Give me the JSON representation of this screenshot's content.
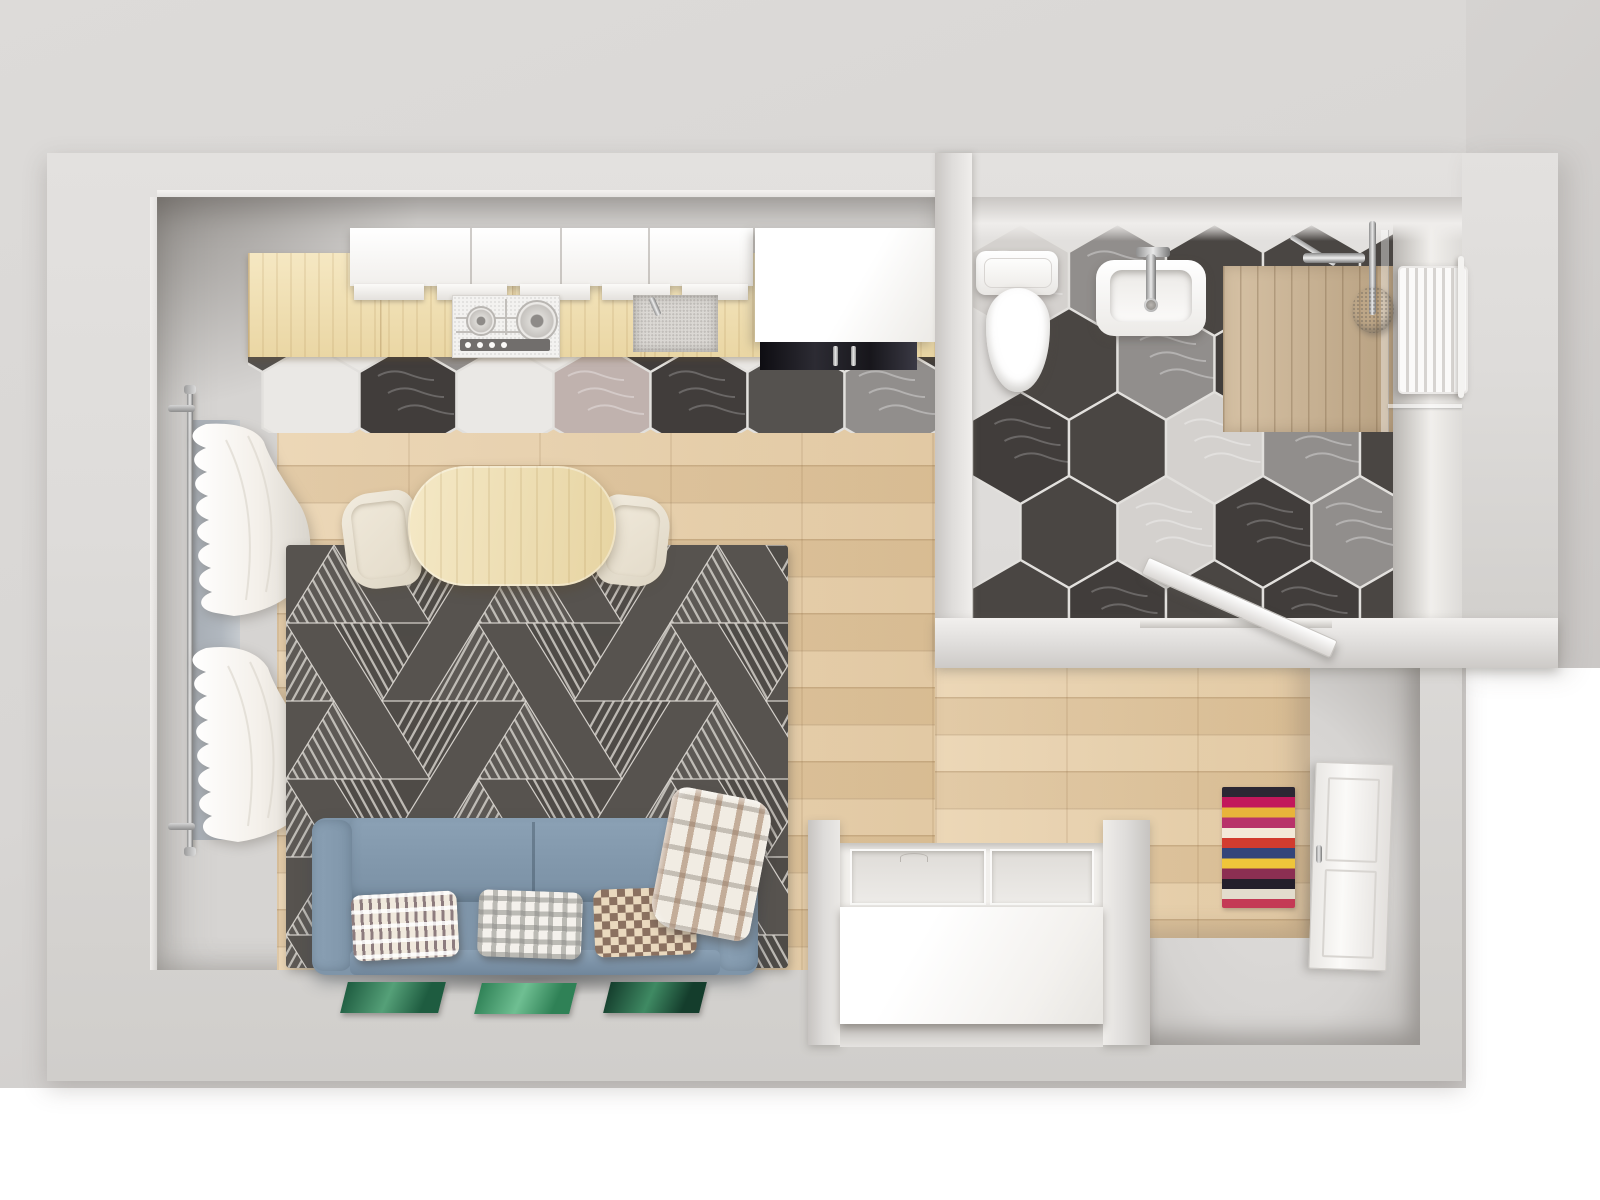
{
  "scene": {
    "kind": "apartment-floor-plan-3d-top-view",
    "rooms": [
      {
        "id": "living-kitchen",
        "floor": "wood-planks"
      },
      {
        "id": "bathroom",
        "floor": "hexagon-tiles"
      },
      {
        "id": "hallway",
        "floor": "wood-planks"
      }
    ],
    "objects": [
      "kitchen-counter",
      "gas-hob",
      "kitchen-sink",
      "upper-cabinets",
      "tall-cabinet",
      "black-appliance",
      "dining-table",
      "chair-left",
      "chair-right",
      "area-rug",
      "sofa",
      "pillow-triangles",
      "pillow-gingham",
      "pillow-checker",
      "plaid-blanket",
      "green-canvases",
      "window-curtains",
      "curtain-rod",
      "toilet",
      "bathroom-sink",
      "shower-deck",
      "shower-column",
      "towel-radiator",
      "pebble-mat",
      "bathroom-door",
      "entry-door",
      "hall-runner-rug",
      "wardrobe-unit"
    ]
  },
  "palette": {
    "backdrop": "#d8d6d4",
    "backdrop_dark": "#cbc8c6",
    "wall": "#dedcda",
    "wall_face": "#f1efed",
    "floor": "#d6d4d2",
    "wood": "#e6cba1",
    "counter": "#f2e0ae",
    "shower_wood": "#cfb795",
    "tile_white": "#eae8e5",
    "tile_light": "#d4d1ce",
    "tile_gray": "#918e8c",
    "tile_pink": "#c0b2ae",
    "tile_dark": "#55524f",
    "tile_darkvein": "#413d3b",
    "tile_bath_dark": "#4a4643",
    "grout": "#e2e0dd",
    "rug_bg": "#57534f",
    "rug_tri_a": "#5e5a56",
    "rug_tri_b": "#4f4b47",
    "rug_line": "#d9d5cf",
    "sofa": "#7f95a9",
    "sofa_dark": "#70869b",
    "sofa_light": "#8ba1b5",
    "cream": "#ece5d6",
    "chrome_l": "#e9e9e9",
    "chrome_d": "#8f8f8f",
    "glass": "#aab2bb",
    "curtain": "#f4f0ea",
    "appliance": "#1a191d",
    "knob_strip": "#716e6c",
    "pillow_base": "#f0e9dd",
    "pillow_brown": "#8b7160",
    "green_a": "#1e5c40",
    "green_b": "#2f8156",
    "green_c": "#143d2c"
  },
  "kitchen_backsplash": {
    "s": 56,
    "pitch": 97,
    "dark_key": "tile_dark",
    "rows": [
      {
        "cy": 43,
        "x0": 63,
        "colors": [
          "white",
          "darkvein",
          "white",
          "pink",
          "darkvein",
          "dark",
          "gray"
        ]
      },
      {
        "cy": -41,
        "x0": 14.5,
        "colors": [
          "dark",
          "white",
          "gray",
          "white",
          "darkvein",
          "white",
          "dark",
          "darkvein"
        ]
      }
    ]
  },
  "bathroom_floor": {
    "s": 56,
    "pitch": 97,
    "dark_key": "tile_bath_dark",
    "rows": [
      {
        "cy": 70,
        "x0": 48.5,
        "colors": [
          "light",
          "gray",
          "dark",
          "dark",
          "dark"
        ]
      },
      {
        "cy": 154,
        "x0": 97,
        "colors": [
          "dark",
          "gray",
          "darkvein",
          "dark",
          "dark"
        ]
      },
      {
        "cy": 238,
        "x0": 48.5,
        "colors": [
          "darkvein",
          "dark",
          "light",
          "gray",
          "dark"
        ]
      },
      {
        "cy": 322,
        "x0": 97,
        "colors": [
          "dark",
          "light",
          "darkvein",
          "gray",
          "pink"
        ]
      },
      {
        "cy": 406,
        "x0": 48.5,
        "colors": [
          "dark",
          "darkvein",
          "dark",
          "darkvein",
          "dark"
        ]
      }
    ]
  },
  "living_rug": {
    "width": 502,
    "height": 423,
    "tri_half": 48,
    "tri_h": 78,
    "rows": 6,
    "cols": 12
  },
  "hall_rug": {
    "stripes": [
      "#2b2733",
      "#c2185b",
      "#e8b43a",
      "#b8336a",
      "#f3ead9",
      "#d23c2f",
      "#34457a",
      "#efc53a",
      "#8c2f52",
      "#241f2b",
      "#e3dccd",
      "#c43a55"
    ]
  },
  "canvases": [
    {
      "base": "#1e5c40",
      "hi": "#55a078"
    },
    {
      "base": "#2f8156",
      "hi": "#6fbf92"
    },
    {
      "base": "#143d2c",
      "hi": "#3f8a63"
    }
  ]
}
